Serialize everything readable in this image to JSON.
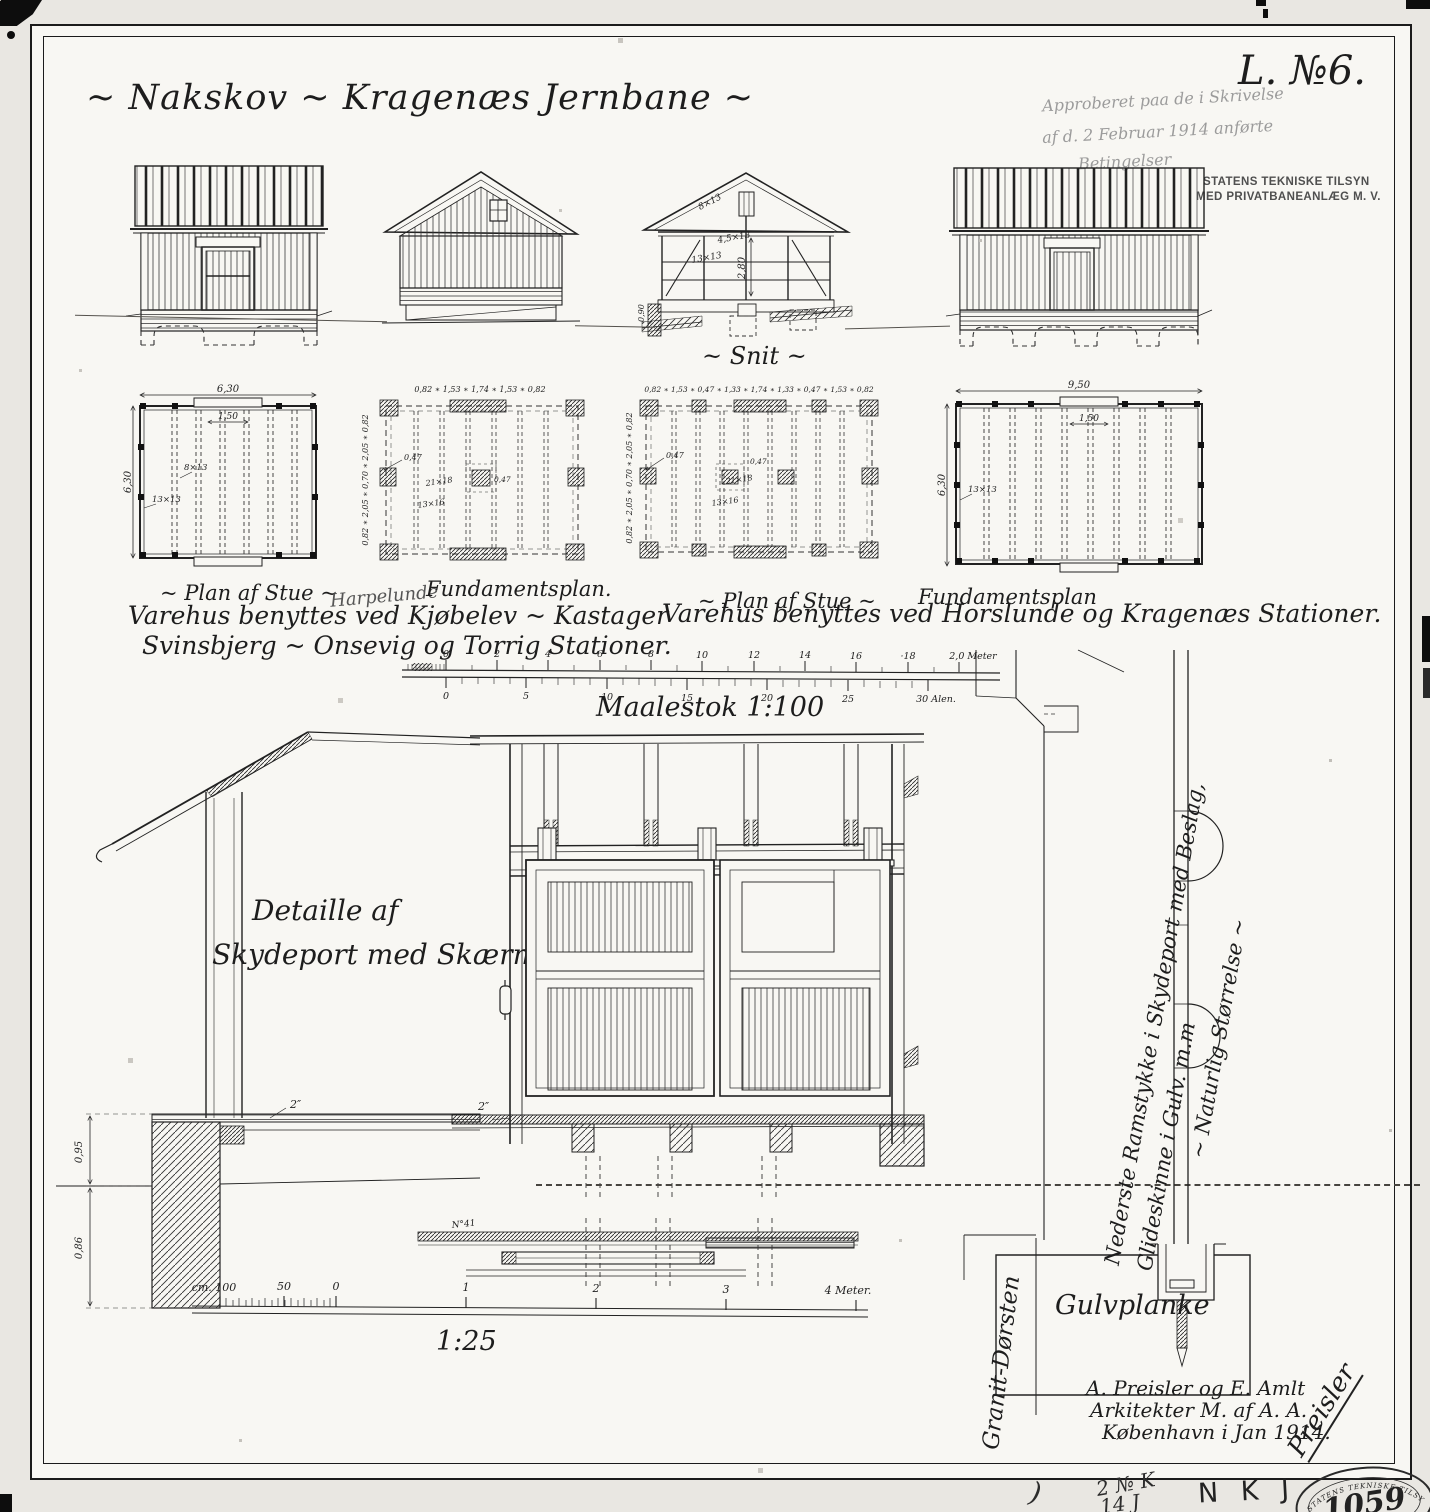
{
  "sheet": {
    "title": "~ Nakskov ~ Kragenæs Jernbane ~",
    "drawing_no": "L. №6.",
    "approval_lines": [
      "Approberet paa de i Skrivelse",
      "af d. 2 Februar 1914 anførte",
      "Betingelser"
    ],
    "agency_lines": [
      "STATENS TEKNISKE TILSYN",
      "MED PRIVATBANEANLÆG M. V."
    ]
  },
  "labels": {
    "snit": "~ Snit ~",
    "plan_stue_small": "~ Plan af Stue ~",
    "harpelunde": "Harpelunde",
    "fundament_small": "Fundamentsplan.",
    "plan_stue_large": "~ Plan af Stue ~",
    "fundament_large": "Fundamentsplan",
    "usage_small_1": "Varehus benyttes ved Kjøbelev ~ Kastager",
    "usage_small_2": "Svinsbjerg ~ Onsevig og Torrig Stationer.",
    "usage_large": "Varehus benyttes ved Horslunde og Kragenæs Stationer.",
    "detail_title_1": "Detaille af",
    "detail_title_2": "Skydeport med Skærm",
    "fullsize_1": "Nederste Ramstykke i Skydeport med Beslag,",
    "fullsize_2": "Glideskinne i Gulv. m.m",
    "fullsize_3": "~ Naturlig Størrelse ~",
    "gulvplanke": "Gulvplanke",
    "granit": "Granit-Dørsten",
    "door_plan_note": "N°41"
  },
  "dims": {
    "plan1_width": "6,30",
    "plan1_height": "6,30",
    "plan1_door": "1,50",
    "plan1_joist": "8×13",
    "plan1_post": "13×13",
    "plan2_top": "0,82 ∗ 1,53 ∗ 1,74 ∗ 1,53 ∗ 0,82",
    "plan2_left": "0,82 ∗ 2,05 ∗ 0,70 ∗ 2,05 ∗ 0,82",
    "plan2_pad": "0,47",
    "plan2_beam": "21×18",
    "plan2_sleeper": "13×16",
    "plan2_pad2": "0,47",
    "plan3_top": "0,82 ∗ 1,53 ∗ 0,47 ∗ 1,33 ∗ 1,74 ∗ 1,33 ∗ 0,47 ∗ 1,53 ∗ 0,82",
    "plan3_left": "0,82 ∗ 2,05 ∗ 0,70 ∗ 2,05 ∗ 0,82",
    "plan3_pad": "0,47",
    "plan3_beam": "21×18",
    "plan3_sleeper": "13×16",
    "plan3_pad2": "0,47",
    "plan4_width": "9,50",
    "plan4_height": "6,30",
    "plan4_door": "1,50",
    "plan4_post": "13×13",
    "sec_rafter": "8×13",
    "sec_collar": "4,5×13",
    "sec_post": "13×13",
    "sec_height": "2,80",
    "sec_found": "0,90",
    "eave_upper": "0,95",
    "eave_lower": "0,86",
    "eave_plank": "2″",
    "door_floor": "2″"
  },
  "scale100": {
    "label": "Maalestok 1:100",
    "meters": [
      "0",
      "2",
      "4",
      "6",
      "8",
      "10",
      "12",
      "14",
      "16",
      "·18",
      "2,0 Meter"
    ],
    "alen": [
      "0",
      "5",
      "10",
      "15",
      "20",
      "25",
      "30 Alen."
    ]
  },
  "scale25": {
    "label": "1:25",
    "ticks": [
      "cm. 100",
      "50",
      "0",
      "1",
      "2",
      "3",
      "4 Meter."
    ]
  },
  "footer": {
    "arch_1": "A. Preisler og E. Amlt",
    "arch_2": "Arkitekter M. af A. A.",
    "arch_3": "København i Jan 1914.",
    "signature": "Preisler",
    "stamp_number": "1059",
    "stamp_top": "STATENS TEKNISKE TILSYN",
    "stamp_bottom": "MED PRIVATBANEANLÆG M.V.",
    "hand_1": "2 № K",
    "hand_2": "14 J",
    "hand_initials": "N K J",
    "hand_paren": ")"
  }
}
